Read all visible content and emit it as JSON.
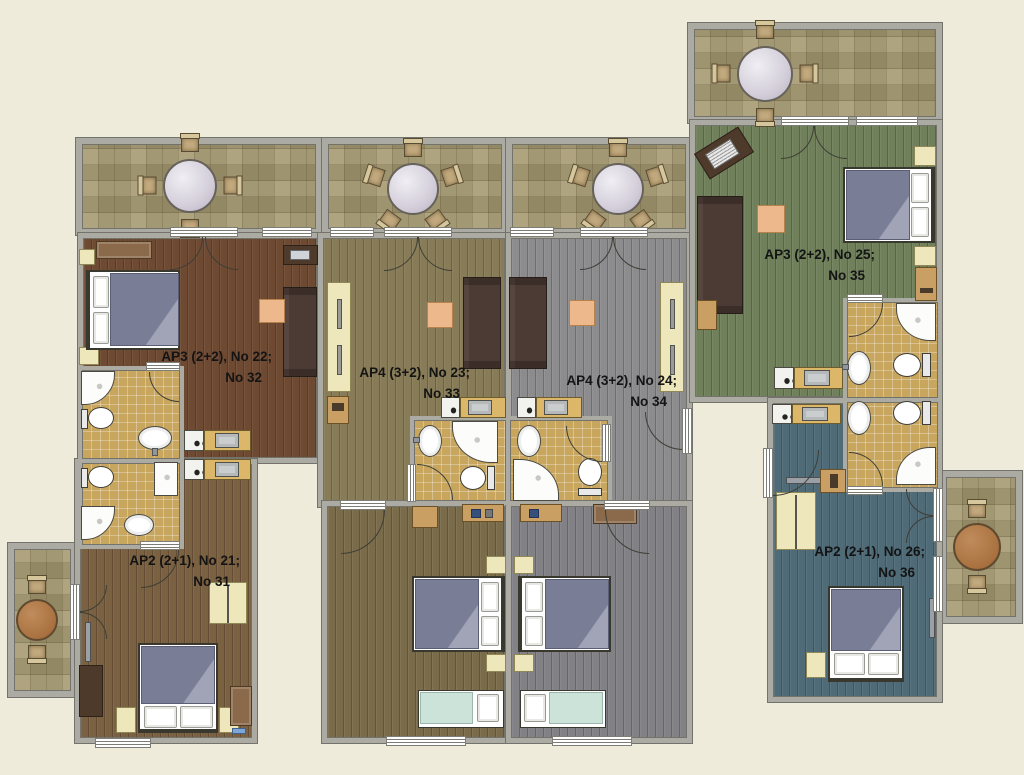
{
  "apartments": [
    {
      "id": "ap-22",
      "line1": "AP3 (2+2), No 22;",
      "line2": "No 32"
    },
    {
      "id": "ap-23",
      "line1": "AP4 (3+2), No 23;",
      "line2": "No 33"
    },
    {
      "id": "ap-24",
      "line1": "AP4 (3+2), No 24;",
      "line2": "No 34"
    },
    {
      "id": "ap-25",
      "line1": "AP3 (2+2), No 25;",
      "line2": "No 35"
    },
    {
      "id": "ap-21",
      "line1": "AP2 (2+1), No 21;",
      "line2": "No 31"
    },
    {
      "id": "ap-26",
      "line1": "AP2 (2+1), No 26;",
      "line2": "No 36"
    }
  ],
  "colors": {
    "bg": "#EFEBDA",
    "wall": "#ABABA4",
    "wallEdge": "#73736C",
    "tile": "#A49870",
    "bath": "#C8A65E",
    "cream": "#EFE7BC",
    "creamEdge": "#8F8756",
    "sofa": "#4C3B34",
    "bedGray": "#797D96",
    "mint": "#CBE3D9",
    "orange": "#EDB98C",
    "counter": "#DCB76A",
    "chair": "#C2A97E",
    "f22": "#6F4A33",
    "f21": "#7A6142",
    "f23": "#877C57",
    "f23b": "#7A6C4A",
    "f24": "#8C8C8E",
    "f24b": "#828286",
    "f25": "#70805B",
    "f26": "#4F6B77"
  }
}
